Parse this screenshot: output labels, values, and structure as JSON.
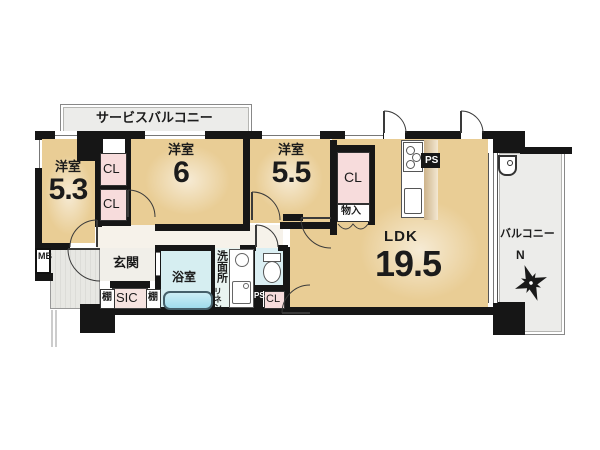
{
  "plan": {
    "service_balcony": "サービスバルコニー",
    "balcony": "バルコニー",
    "compass": "N",
    "rooms": {
      "bedroom1": {
        "type": "洋室",
        "size": "5.3"
      },
      "bedroom2": {
        "type": "洋室",
        "size": "6"
      },
      "bedroom3": {
        "type": "洋室",
        "size": "5.5"
      },
      "ldk": {
        "type": "LDK",
        "size": "19.5"
      }
    },
    "storage": {
      "cl_b1_upper": "CL",
      "cl_b1_lower": "CL",
      "cl_b3": "CL",
      "cl_hall": "CL",
      "mono_ire": "物入",
      "sic": "SIC",
      "shelf_left": "棚",
      "shelf_right": "棚",
      "linen": "リネン"
    },
    "entrance": {
      "genkan": "玄関",
      "meter_box": "MB"
    },
    "sanitary": {
      "bath": "浴室",
      "washroom": "洗面所"
    },
    "utility": {
      "ps_kitchen": "PS",
      "ps_lower": "PS"
    }
  }
}
